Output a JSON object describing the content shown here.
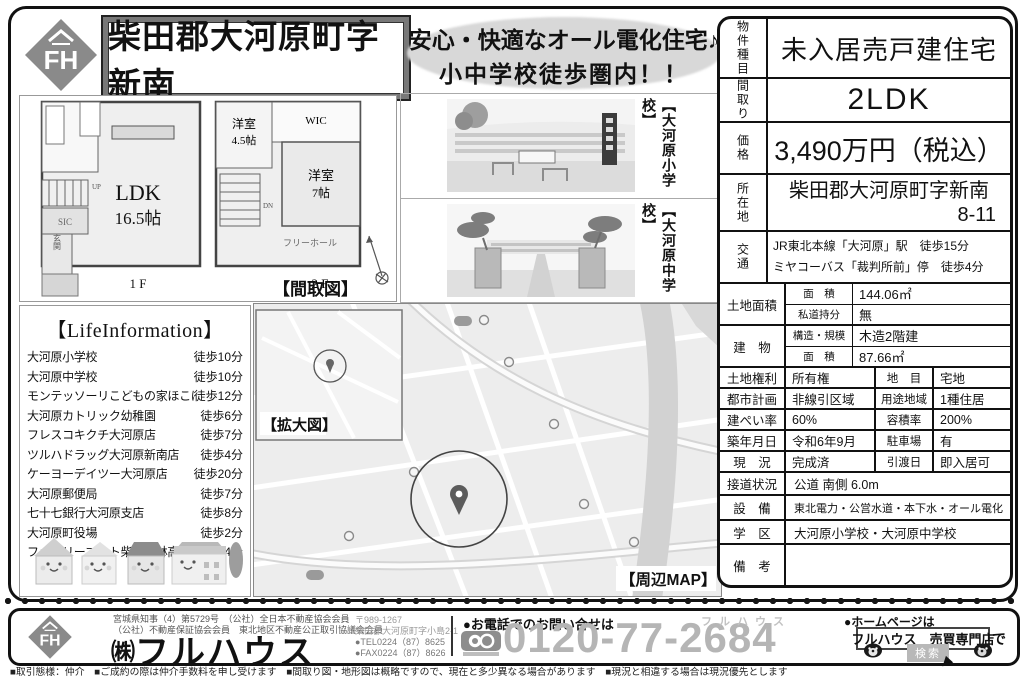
{
  "colors": {
    "accent_gray": "#8a8a8a",
    "phone_number_gray": "#b5b5b5",
    "headline_ellipse": "#d8d8d8"
  },
  "header": {
    "logo_text": "FH",
    "title": "柴田郡大河原町字新南",
    "headline_line1": "安心・快適なオール電化住宅♪",
    "headline_line2": "小中学校徒歩圏内！！"
  },
  "floorplan": {
    "caption": "【間取図】",
    "floor1_label": "1 F",
    "floor2_label": "2 F",
    "ldk": "LDK",
    "ldk_size": "16.5帖",
    "room45": "洋室",
    "room45_size": "4.5帖",
    "wic": "WIC",
    "room7": "洋室",
    "room7_size": "7帖",
    "free_hall": "フリーホール",
    "sic": "SIC",
    "genkan": "玄関",
    "up": "UP",
    "dn": "DN"
  },
  "photos": {
    "items": [
      {
        "caption": "【大河原小学校】"
      },
      {
        "caption": "【大河原中学校】"
      }
    ]
  },
  "life": {
    "title": "【LifeInformation】",
    "items": [
      {
        "name": "大河原小学校",
        "time": "徒歩10分"
      },
      {
        "name": "大河原中学校",
        "time": "徒歩10分"
      },
      {
        "name": "モンテッソーリこどもの家ほこほこ",
        "time": "徒歩12分"
      },
      {
        "name": "大河原カトリック幼稚園",
        "time": "徒歩6分"
      },
      {
        "name": "フレスコキクチ大河原店",
        "time": "徒歩7分"
      },
      {
        "name": "ツルハドラッグ大河原新南店",
        "time": "徒歩4分"
      },
      {
        "name": "ケーヨーデイツー大河原店",
        "time": "徒歩20分"
      },
      {
        "name": "大河原郵便局",
        "time": "徒歩7分"
      },
      {
        "name": "七十七銀行大河原支店",
        "time": "徒歩8分"
      },
      {
        "name": "大河原町役場",
        "time": "徒歩2分"
      },
      {
        "name": "ファミリーマート柴田農林高前店",
        "time": "徒歩4分"
      }
    ]
  },
  "map": {
    "inset_caption": "【拡大図】",
    "caption": "【周辺MAP】"
  },
  "spec": {
    "r1": {
      "label": "物件種目",
      "value": "未入居売戸建住宅"
    },
    "r2": {
      "label": "間取り",
      "value": "2LDK"
    },
    "r3": {
      "label": "価格",
      "value": "3,490万円（税込）"
    },
    "r4": {
      "label": "所在地",
      "value": "柴田郡大河原町字新南",
      "value2": "8-11"
    },
    "r5": {
      "label": "交通",
      "line1": "JR東北本線「大河原」駅　徒歩15分",
      "line2": "ミヤコーバス「裁判所前」停　徒歩4分"
    },
    "r6": {
      "label": "土地面積",
      "k1": "面　積",
      "v1": "144.06㎡",
      "k2": "私道持分",
      "v2": "無"
    },
    "r7": {
      "label": "建　物",
      "k1": "構造・規模",
      "v1": "木造2階建",
      "k2": "面　積",
      "v2": "87.66㎡"
    },
    "r8": {
      "label": "土地権利",
      "v1": "所有権",
      "label2": "地　目",
      "v2": "宅地"
    },
    "r9": {
      "label": "都市計画",
      "v1": "非線引区域",
      "label2": "用途地域",
      "v2": "1種住居"
    },
    "r10": {
      "label": "建ぺい率",
      "v1": "60%",
      "label2": "容積率",
      "v2": "200%"
    },
    "r11": {
      "label": "築年月日",
      "v1": "令和6年9月",
      "label2": "駐車場",
      "v2": "有"
    },
    "r12": {
      "label": "現　況",
      "v1": "完成済",
      "label2": "引渡日",
      "v2": "即入居可"
    },
    "r13": {
      "label": "接道状況",
      "value": "公道 南側 6.0m"
    },
    "r14": {
      "label": "設　備",
      "value": "東北電力・公営水道・本下水・オール電化"
    },
    "r15": {
      "label": "学　区",
      "value": "大河原小学校・大河原中学校"
    },
    "r16": {
      "label": "備　考",
      "value": ""
    }
  },
  "footer": {
    "license1": "宮城県知事（4）第5729号　（公社）全日本不動産協会会員",
    "license2": "（公社）不動産保証協会会員　東北地区不動産公正取引協議会会員",
    "company_prefix": "㈱",
    "company_name": "フルハウス",
    "postal": "〒989-1267",
    "address": "柴田郡大河原町字小島2-1",
    "tel": "●TEL0224（87）8625",
    "fax": "●FAX0224（87）8626",
    "phone_label": "●お電話でのお問い合せは",
    "phone_brand": "フルハウス",
    "phone_number": "0120-77-2684",
    "homepage_label": "●ホームページは",
    "search_text": "フルハウス　売買専門店",
    "search_suffix": "で",
    "search_button": "検索",
    "disclaimer": "■取引態様：仲介　■ご成約の際は仲介手数料を申し受けます　■間取り図・地形図は概略ですので、現在と多少異なる場合があります　■現況と相違する場合は現況優先とします"
  }
}
